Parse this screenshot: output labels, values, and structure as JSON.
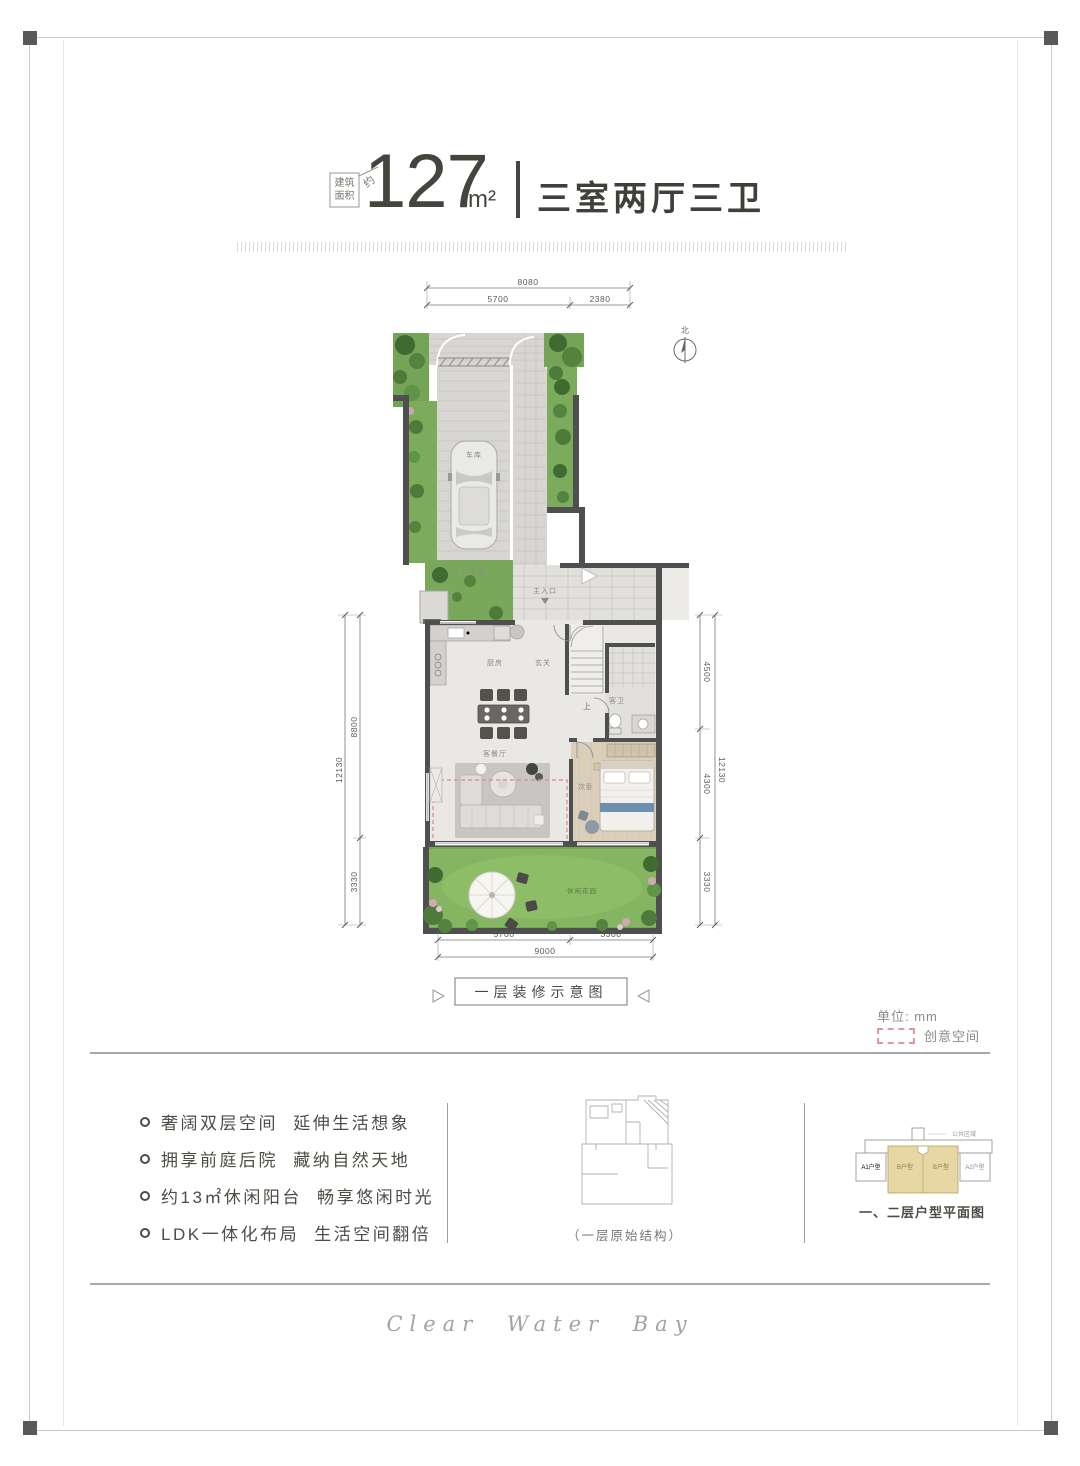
{
  "header": {
    "area_prefix_line1": "建筑",
    "area_prefix_line2": "面积",
    "area_prefix_approx": "约",
    "area_value": "127",
    "area_unit": "m²",
    "layout_title": "三室两厅三卫"
  },
  "plan": {
    "compass_label": "北",
    "caption": "一层装修示意图",
    "unit_note": "单位: mm",
    "legend_creative_space": "创意空间",
    "dimensions": {
      "top_total": "8080",
      "top_left": "5700",
      "top_right": "2380",
      "left_outer": "12130",
      "left_upper": "8800",
      "left_lower": "3330",
      "right_upper": "4500",
      "right_middle": "4300",
      "right_lower": "3330",
      "right_outer": "12130",
      "bottom_left": "5700",
      "bottom_right": "3300",
      "bottom_total": "9000"
    },
    "labels": {
      "garage": "车库",
      "entry_garden": "入户花园",
      "main_entrance": "主入口",
      "kitchen": "厨房",
      "foyer": "玄关",
      "guest_bath": "客卫",
      "stairs_up": "上",
      "living_dining": "客餐厅",
      "second_bedroom": "次卧",
      "leisure_garden": "休闲花园"
    }
  },
  "features": {
    "items": [
      "奢阔双层空间 延伸生活想象",
      "拥享前庭后院 藏纳自然天地",
      "约13㎡休闲阳台 畅享悠闲时光",
      "LDK一体化布局 生活空间翻倍"
    ]
  },
  "thumbnails": {
    "original_structure_caption": "（一层原始结构）",
    "key_plan_caption": "一、二层户型平面图",
    "key_plan": {
      "public_area": "公共区域",
      "unit_a1": "A1户型",
      "unit_b_left": "B户型",
      "unit_b_right": "B户型",
      "unit_a2": "A2户型"
    }
  },
  "footer": {
    "script_text": "Clear Water Bay"
  },
  "colors": {
    "creative_dash": "#e09292",
    "key_plan_highlight": "#e6d7a5",
    "lawn_green": "#85b561",
    "wall_gray": "#4f4f4f"
  }
}
